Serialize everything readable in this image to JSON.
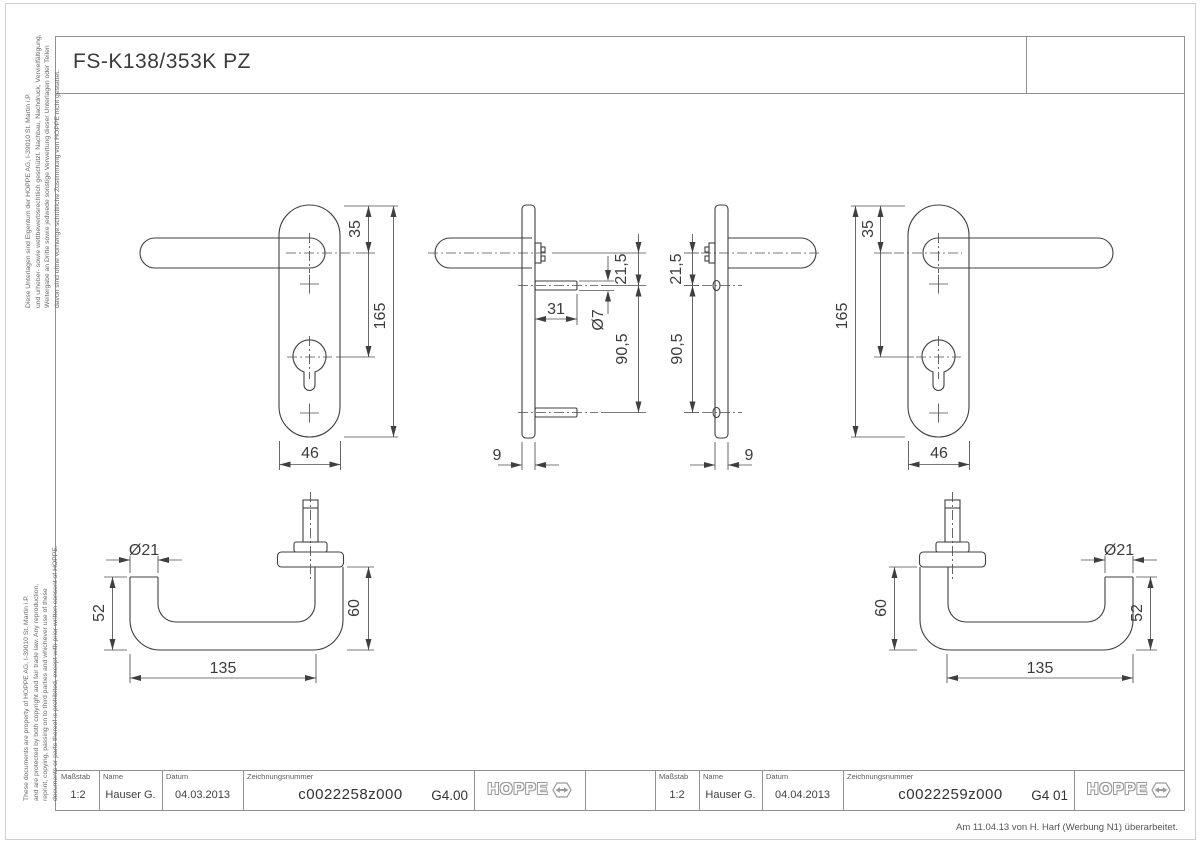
{
  "header": {
    "title": "FS-K138/353K PZ"
  },
  "margin_notes": {
    "german": [
      "Diese Unterlagen sind Eigentum der  HOPPE AG, I-39010 St. Martin i.P.",
      "und urheber- sowie wettbewerbsrechtlich geschützt. Nachbau, Nachdruck, Vervielfältigung,",
      "Weitergabe an Dritte sowie jedwede sonstige Verwertung dieser Unterlagen oder Teilen",
      "davon sind ohne vorherige schriftliche Zustimmung von HOPPE nicht gestattet."
    ],
    "english": [
      "These documents are property of HOPPE AG, I-39010 St. Martin i.P.",
      "and are protected by both copyright and fair trade law. Any reproduction,",
      "reprint, copying, passing on to third parties and whichever use of these",
      "documents or parts thereof is prohibited, except with prior written consent of HOPPE."
    ]
  },
  "footer_note": "Am 11.04.13 von H. Harf (Werbung N1) überarbeitet.",
  "title_blocks": {
    "labels": {
      "scale": "Maßstab",
      "name": "Name",
      "date": "Datum",
      "drawing_number": "Zeichnungsnummer"
    },
    "left": {
      "scale": "1:2",
      "name": "Hauser G.",
      "date": "04.03.2013",
      "drawing_number": "c0022258z000",
      "revision": "G4.00",
      "brand": "HOPPE"
    },
    "right": {
      "scale": "1:2",
      "name": "Hauser G.",
      "date": "04.04.2013",
      "drawing_number": "c0022259z000",
      "revision": "G4 01",
      "brand": "HOPPE"
    }
  },
  "dimensions": {
    "front_left": {
      "plate_top_to_handle": "35",
      "plate_height": "165",
      "plate_width": "46"
    },
    "side_left": {
      "pin_length": "31",
      "pin_diameter": "Ø7",
      "handle_to_pin": "21,5",
      "pin_spacing": "90,5",
      "plate_thickness": "9"
    },
    "side_right": {
      "handle_to_pin": "21,5",
      "pin_spacing": "90,5",
      "plate_thickness": "9"
    },
    "front_right": {
      "plate_top_to_handle": "35",
      "plate_height": "165",
      "plate_width": "46"
    },
    "top_left": {
      "grip_diameter": "Ø21",
      "grip_end_height": "52",
      "handle_length": "135",
      "handle_height": "60"
    },
    "top_right": {
      "handle_height": "60",
      "grip_diameter": "Ø21",
      "grip_end_height": "52",
      "handle_length": "135"
    }
  }
}
